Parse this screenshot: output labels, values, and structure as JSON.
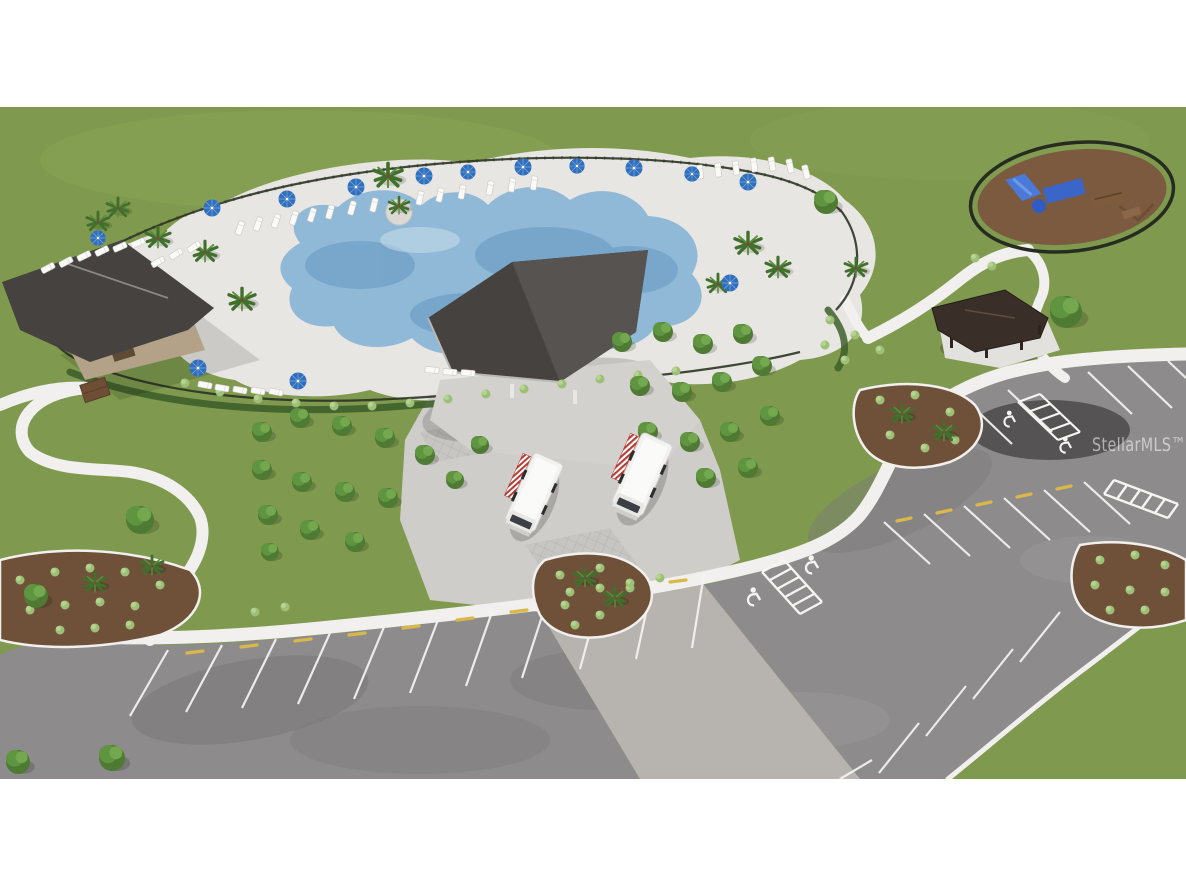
{
  "meta": {
    "description": "Aerial 3D rendering of a community amenity center: resort-style freeform pool with lounge chairs and blue umbrellas, clubhouse with charcoal roof, large open-air event pavilion, two food trucks, shaded tree groves with seating, fenced circular playground, picnic pavilion, and landscaped parking lots with handicap stalls"
  },
  "watermark": {
    "text": "StellarMLS™"
  },
  "scene": {
    "amenities": [
      "resort-style-pool",
      "pool-deck",
      "clubhouse",
      "event-pavilion",
      "food-truck-plaza",
      "tree-grove-seating",
      "playground",
      "picnic-pavilion",
      "parking-lot",
      "walking-paths"
    ],
    "food_truck_count": 2,
    "umbrella_count": 14,
    "letterbox": "white bands above and below the rendering"
  },
  "colors": {
    "background": "#ffffff",
    "lawn": "#7f9a4e",
    "asphalt": "#8e8b8c",
    "sidewalk": "#f1f0ee",
    "parking_line": "#f5f5f3",
    "wheel_stop_yellow": "#d9b84a",
    "pool_water": "#8fb9d6",
    "pool_water_deep": "#6f9fc6",
    "pool_deck": "#e8e6e2",
    "roof_charcoal": "#45423f",
    "roof_brown": "#3a2f28",
    "mulch": "#6e5138",
    "tree_green": "#4e7a33",
    "shrub_green": "#9dbf77",
    "hedge_green": "#3f5f2c",
    "umbrella_blue": "#2f6fbe",
    "truck_white": "#f2f2f0",
    "awning_red": "#b63b34",
    "playground_blue": "#3a66c9",
    "playground_mulch": "#7b5a3f",
    "fence_dark": "#2c3325",
    "watermark_white": "#ffffff"
  }
}
